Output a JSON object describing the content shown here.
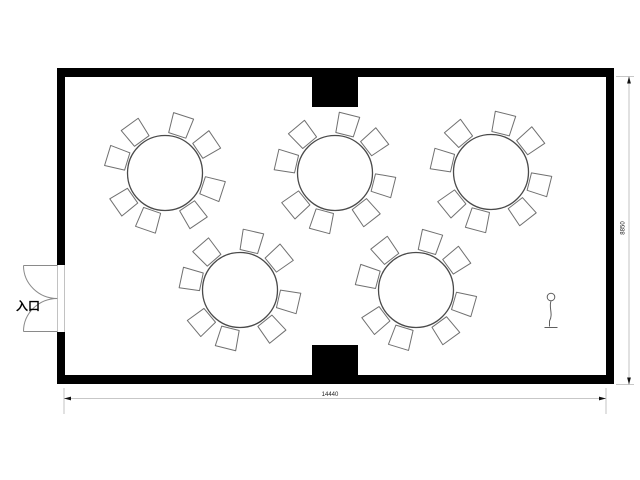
{
  "labels": {
    "entrance": "入口"
  },
  "dimensions": {
    "width_label": "14440",
    "height_label": "8850"
  },
  "floorplan": {
    "colors": {
      "wall": "#000000",
      "table_stroke": "#4a4a4a",
      "chair_stroke": "#707070",
      "dimension_line": "#b4b4b4",
      "text": "#000000"
    },
    "room": {
      "x": 57,
      "y": 68,
      "width": 557,
      "height": 316,
      "wall_thickness": 9
    },
    "pillars": [
      {
        "x": 312,
        "y": 68,
        "width": 46,
        "height": 39
      },
      {
        "x": 312,
        "y": 345,
        "width": 46,
        "height": 39
      }
    ],
    "door": {
      "opening_top": 265,
      "opening_bottom": 332,
      "leaf_length": 34
    },
    "table_radius": 37.5,
    "chairs_per_table": 8,
    "chair_distance": 50,
    "chair_angle_jitter": [
      4,
      -3,
      5,
      -4,
      3,
      -5,
      4,
      -3
    ],
    "tables": [
      {
        "cx": 165,
        "cy": 173,
        "phase": 14
      },
      {
        "cx": 335,
        "cy": 173,
        "phase": 10
      },
      {
        "cx": 491,
        "cy": 172,
        "phase": 10
      },
      {
        "cx": 240,
        "cy": 290,
        "phase": 9
      },
      {
        "cx": 416,
        "cy": 290,
        "phase": 12
      }
    ],
    "scale_figure": {
      "x": 551,
      "y": 297
    }
  }
}
